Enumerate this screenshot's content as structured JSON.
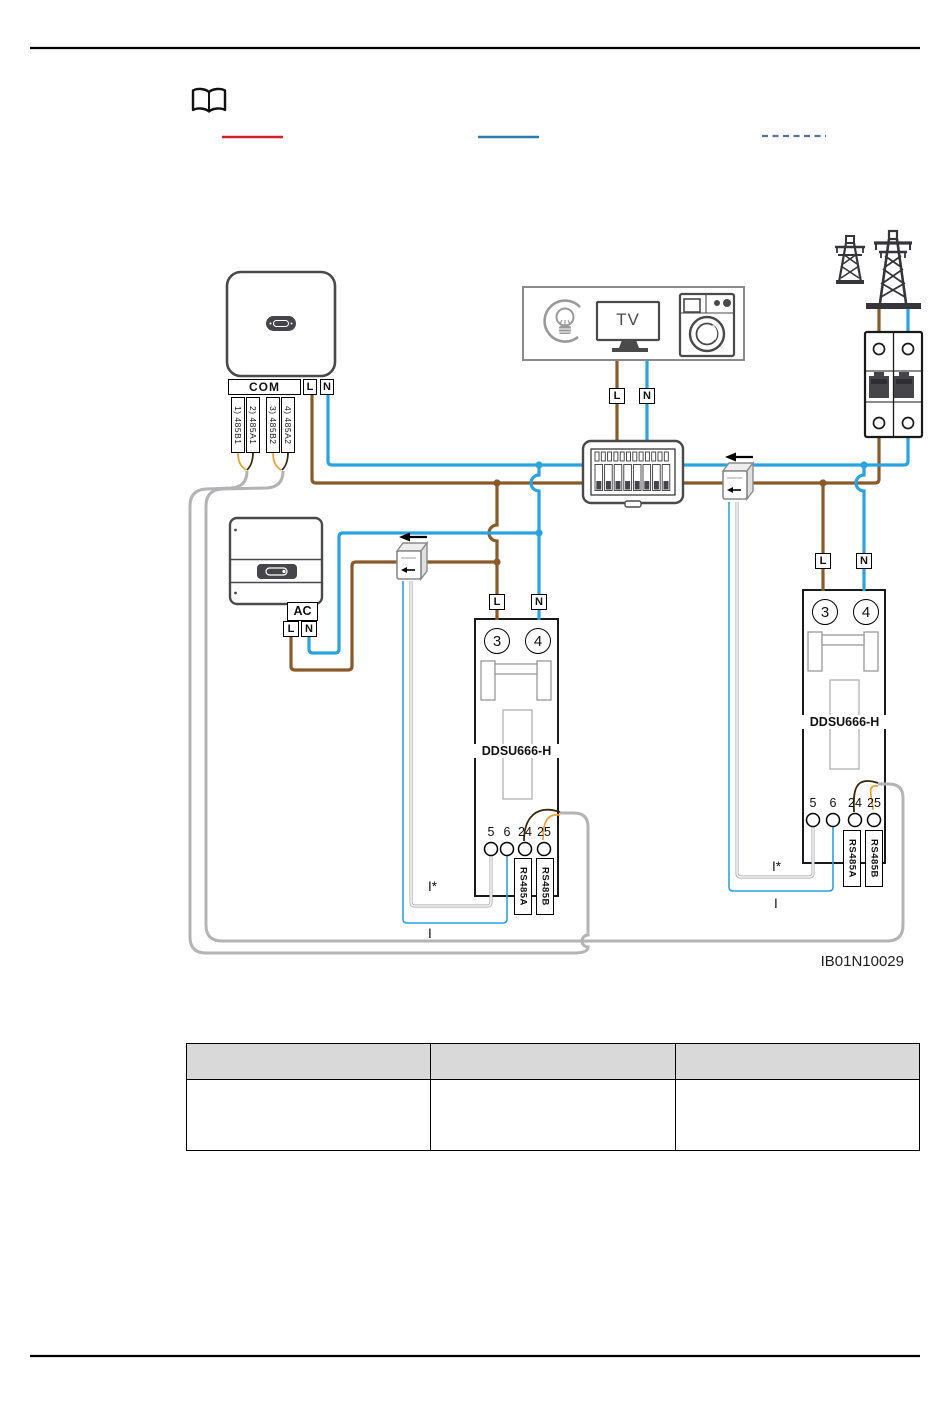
{
  "colors": {
    "live_brown": "#8a5a28",
    "neutral_blue": "#2aa4e0",
    "signal_gray": "#b4b4b7",
    "rs485_orange": "#efa23a",
    "rs485_dark": "#38290f",
    "legend_red": "#d2202f",
    "legend_blue": "#2b7cab",
    "legend_dashed": "#5572a0"
  },
  "legend": {
    "entries": [
      {
        "style": "solid",
        "color": "#d2202f"
      },
      {
        "style": "solid",
        "color": "#2b7cab"
      },
      {
        "style": "dashed",
        "color": "#5572a0"
      }
    ]
  },
  "inverter1": {
    "com_label": "COM",
    "l_label": "L",
    "n_label": "N",
    "rs485_terminals": [
      "1) 485B1",
      "2) 485A1",
      "3) 485B2",
      "4) 485A2"
    ]
  },
  "loads": {
    "tv_label": "TV",
    "l_label": "L",
    "n_label": "N"
  },
  "inverter2": {
    "ac_label": "AC",
    "l_label": "L",
    "n_label": "N"
  },
  "meter_left": {
    "model": "DDSU666-H",
    "l_label": "L",
    "n_label": "N",
    "terminal_3": "3",
    "terminal_4": "4",
    "terminal_5": "5",
    "terminal_6": "6",
    "terminal_24": "24",
    "terminal_25": "25",
    "rs485a_label": "RS485A",
    "rs485b_label": "RS485B",
    "current_in_label": "I*",
    "current_out_label": "I"
  },
  "meter_right": {
    "model": "DDSU666-H",
    "l_label": "L",
    "n_label": "N",
    "terminal_3": "3",
    "terminal_4": "4",
    "terminal_5": "5",
    "terminal_6": "6",
    "terminal_24": "24",
    "terminal_25": "25",
    "rs485a_label": "RS485A",
    "rs485b_label": "RS485B",
    "current_in_label": "I*",
    "current_out_label": "I"
  },
  "figure_code": "IB01N10029",
  "table": {
    "header": [
      "",
      "",
      ""
    ],
    "rows": [
      [
        "",
        "",
        ""
      ]
    ]
  }
}
